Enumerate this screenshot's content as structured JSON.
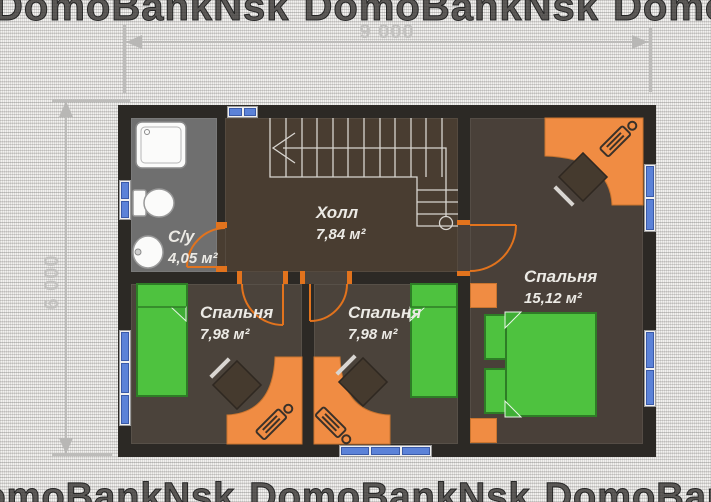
{
  "watermark": {
    "text": "DomoBankNsk"
  },
  "dimensions": {
    "width_label": "9 000",
    "height_label": "6 000"
  },
  "floor_plan": {
    "level": "second-floor",
    "rooms": [
      {
        "id": "bathroom",
        "name": "С/у",
        "area": "4,05 м²"
      },
      {
        "id": "hall",
        "name": "Холл",
        "area": "7,84 м²"
      },
      {
        "id": "bedroom_left",
        "name": "Спальня",
        "area": "7,98 м²"
      },
      {
        "id": "bedroom_middle",
        "name": "Спальня",
        "area": "7,98 м²"
      },
      {
        "id": "bedroom_right",
        "name": "Спальня",
        "area": "15,12 м²"
      }
    ]
  },
  "colors": {
    "wall": "#2c2925",
    "hall_floor": "#493d31",
    "bedroom_floor": "#4b433b",
    "bathroom_floor": "#6f6f6f",
    "furniture_orange": "#f08c43",
    "furniture_green": "#4ec23f",
    "window_glass": "#5b82d8",
    "door_swing": "#e2731d",
    "dimension_gray": "#bdbcba",
    "label_text": "#eceae5"
  }
}
